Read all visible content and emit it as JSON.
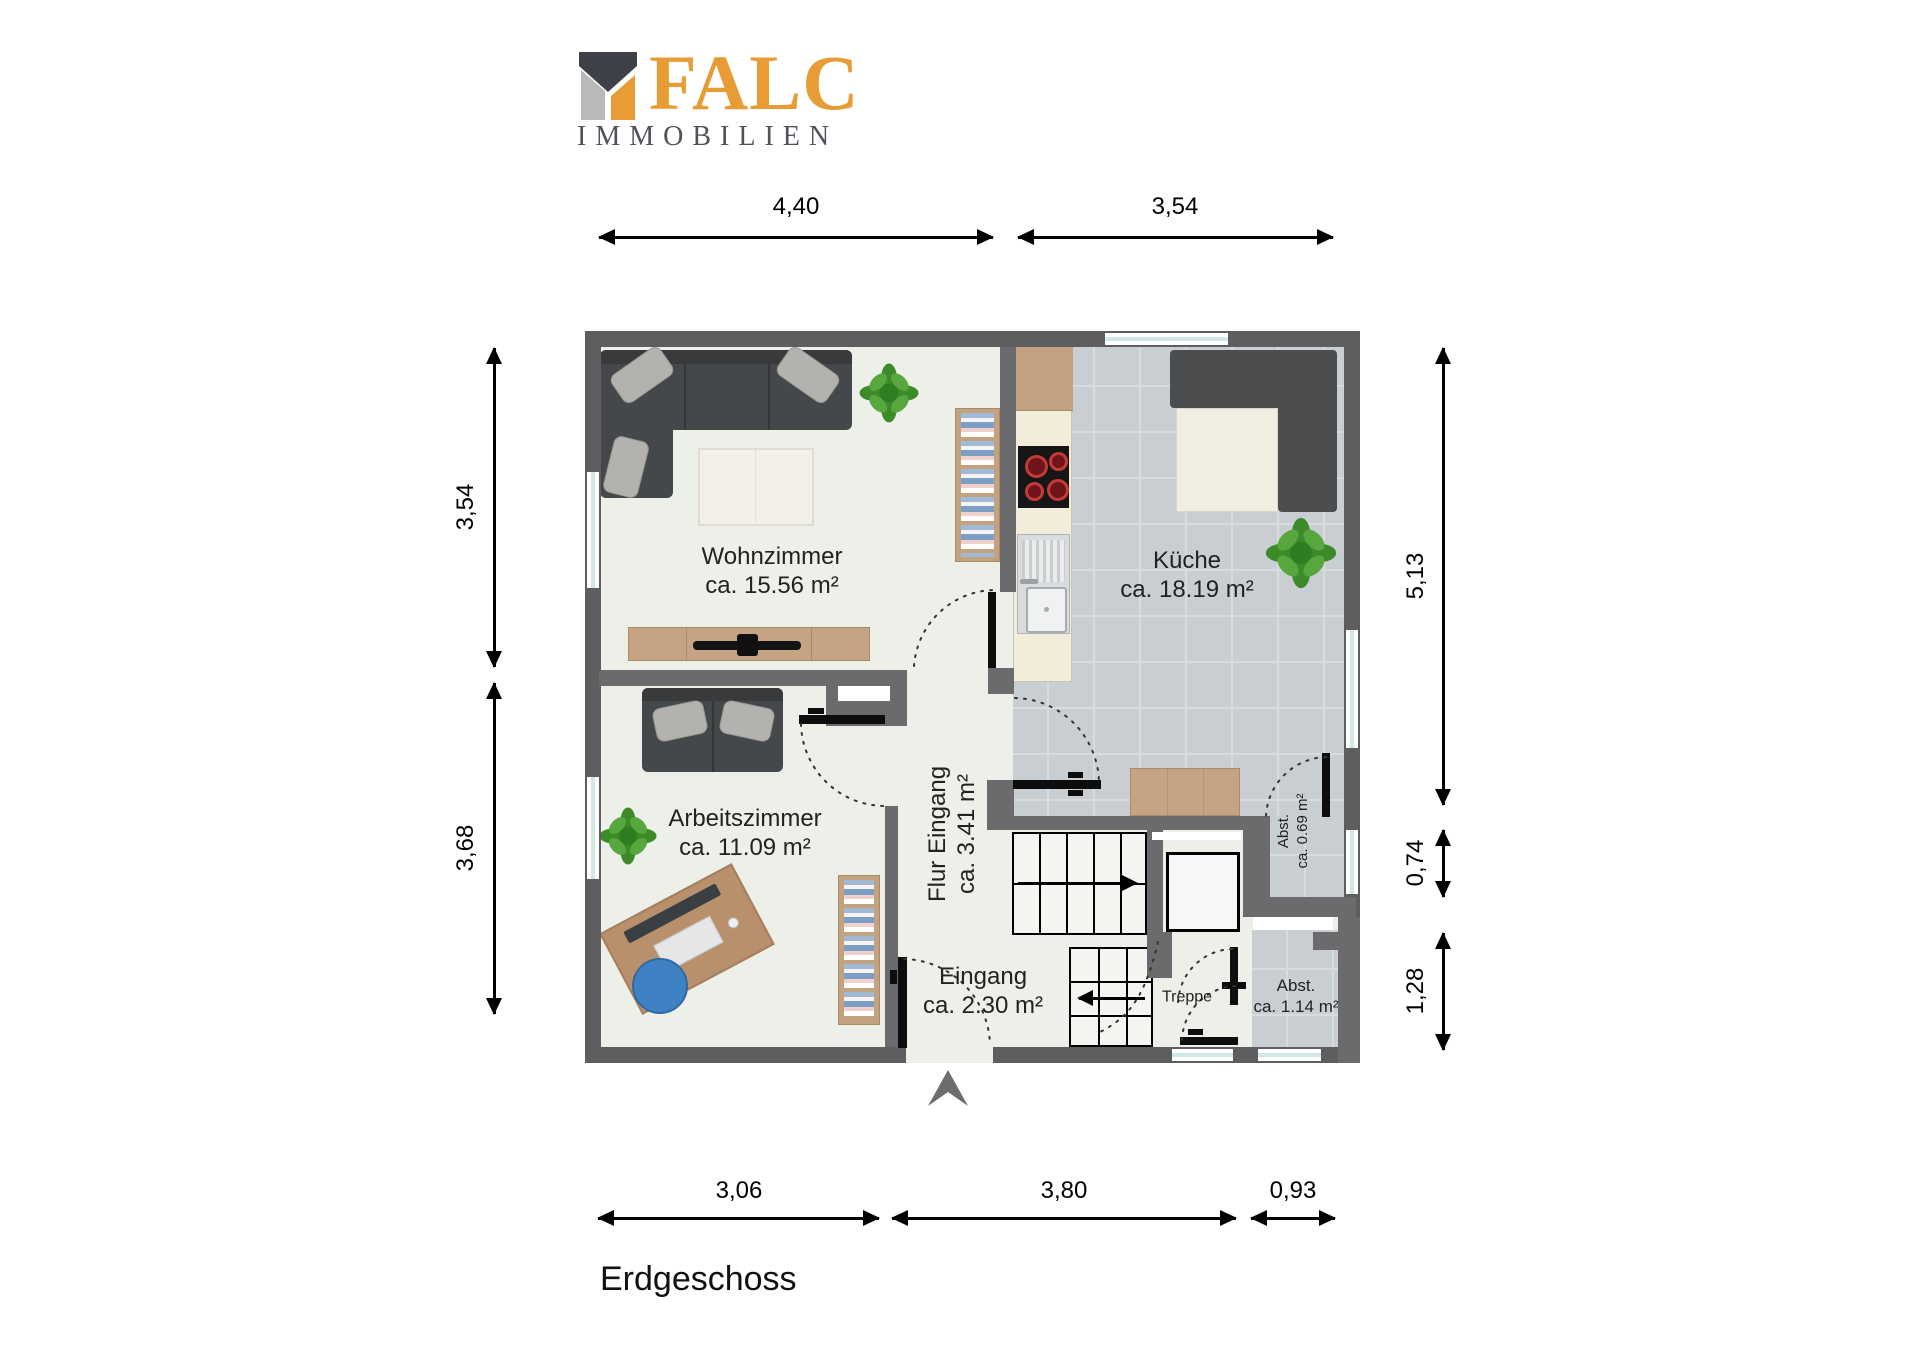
{
  "brand": {
    "name": "FALC",
    "tagline": "IMMOBILIEN"
  },
  "floor_title": "Erdgeschoss",
  "rooms": {
    "wohnzimmer": {
      "name": "Wohnzimmer",
      "area": "ca. 15.56 m²"
    },
    "kueche": {
      "name": "Küche",
      "area": "ca. 18.19 m²"
    },
    "arbeitszimmer": {
      "name": "Arbeitszimmer",
      "area": "ca. 11.09 m²"
    },
    "flur": {
      "name": "Flur Eingang",
      "area": "ca. 3.41 m²"
    },
    "eingang": {
      "name": "Eingang",
      "area": "ca. 2.30 m²"
    },
    "treppe": {
      "name": "Treppe"
    },
    "abst_klein": {
      "name": "Abst.",
      "area": "ca. 0.69 m²"
    },
    "abst_gross": {
      "name": "Abst.",
      "area": "ca. 1.14 m²"
    }
  },
  "dimensions": {
    "top": [
      "4,40",
      "3,54"
    ],
    "left": [
      "3,54",
      "3,68"
    ],
    "right": [
      "5,13",
      "0,74",
      "1,28"
    ],
    "bottom": [
      "3,06",
      "3,80",
      "0,93"
    ]
  },
  "colors": {
    "brand_orange": "#E79C35",
    "brand_gray": "#B9B9B9",
    "brand_dark": "#3E4147",
    "wall_gray": "#5E5E60",
    "tile_gray_blue": "#C9CED3",
    "floor_light": "#EDEFE9",
    "plant_green": "#4C9B35",
    "chair_blue": "#3E82C4"
  }
}
